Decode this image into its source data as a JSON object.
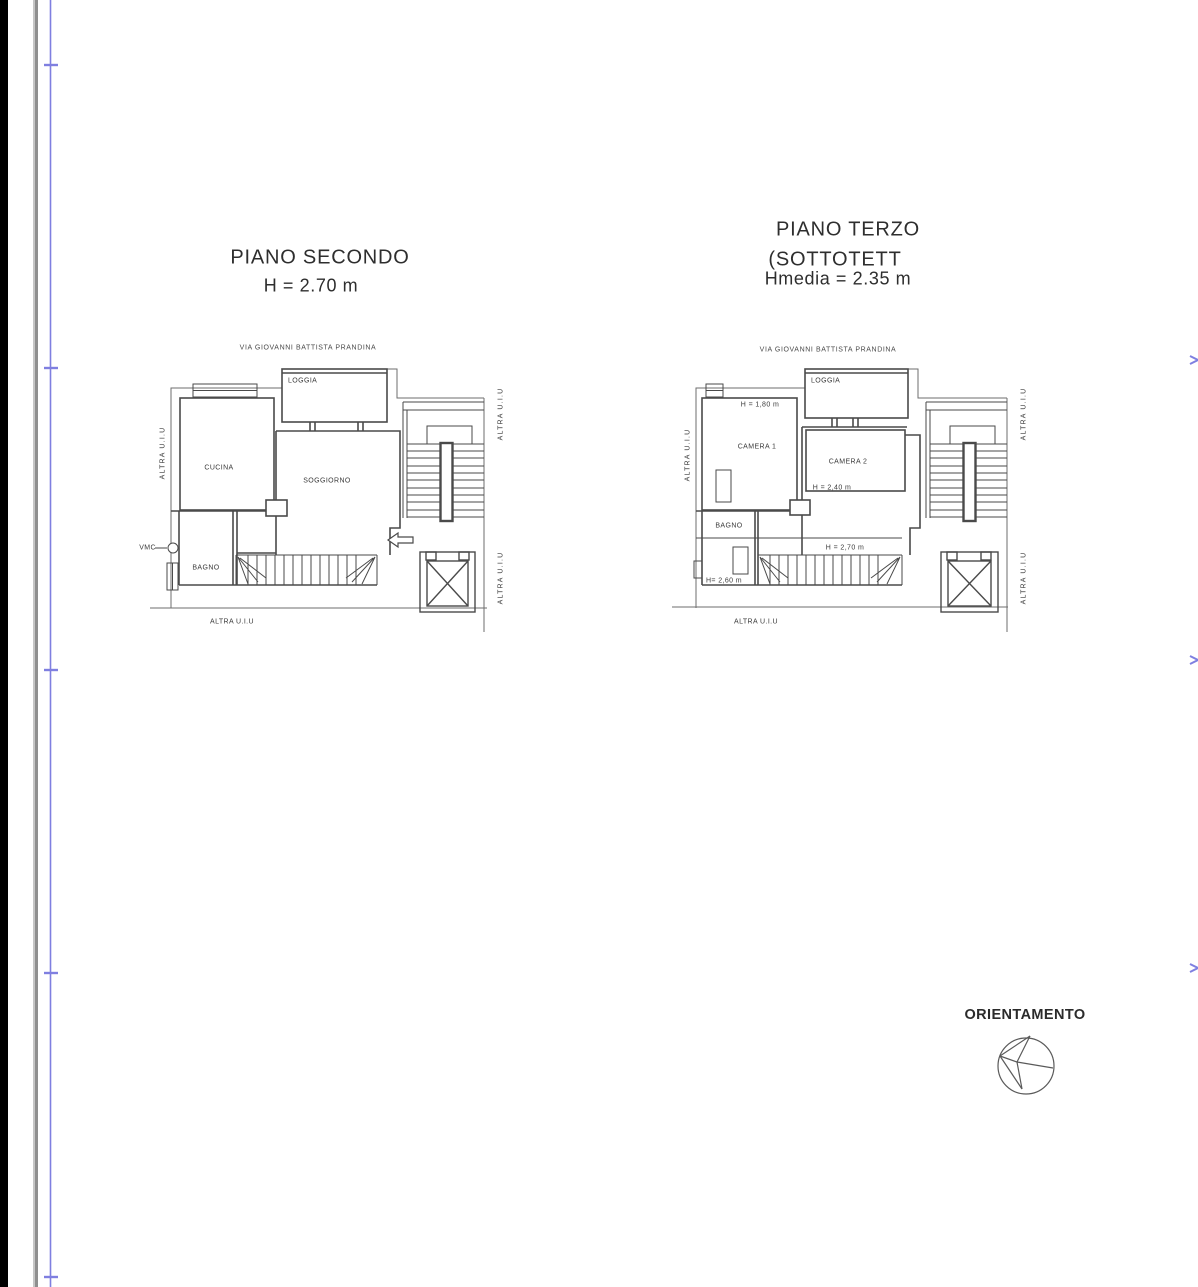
{
  "sheet": {
    "colors": {
      "scan_edge_black": "#000000",
      "scan_gray_line": "#8f8f8f",
      "fold_line_blue": "#7f7fe0",
      "drawing_line": "#444444"
    }
  },
  "plan_left": {
    "title": "PIANO SECONDO",
    "subtitle": "H = 2.70 m",
    "street_label": "VIA GIOVANNI BATTISTA PRANDINA",
    "rooms": {
      "loggia": "LOGGIA",
      "cucina": "CUCINA",
      "soggiorno": "SOGGIORNO",
      "bagno": "BAGNO"
    },
    "annotations": {
      "vmc": "VMC"
    },
    "adjacent_units": {
      "left": "ALTRA U.I.U",
      "right_top": "ALTRA U.I.U",
      "right_bottom": "ALTRA U.I.U",
      "bottom": "ALTRA U.I.U"
    }
  },
  "plan_right": {
    "title": "PIANO TERZO",
    "subtitle": "(SOTTOTETT",
    "subtitle2": "Hmedia = 2.35 m",
    "street_label": "VIA GIOVANNI BATTISTA PRANDINA",
    "rooms": {
      "loggia": "LOGGIA",
      "camera1": "CAMERA 1",
      "camera2": "CAMERA 2",
      "bagno": "BAGNO"
    },
    "heights": {
      "camera1": "H = 1,80 m",
      "camera2": "H = 2,40 m",
      "zone": "H = 2,70 m",
      "bagno": "H= 2,60 m"
    },
    "adjacent_units": {
      "left": "ALTRA U.I.U",
      "right_top": "ALTRA U.I.U",
      "right_bottom": "ALTRA U.I.U",
      "bottom": "ALTRA U.I.U"
    }
  },
  "orientation": {
    "label": "ORIENTAMENTO"
  }
}
